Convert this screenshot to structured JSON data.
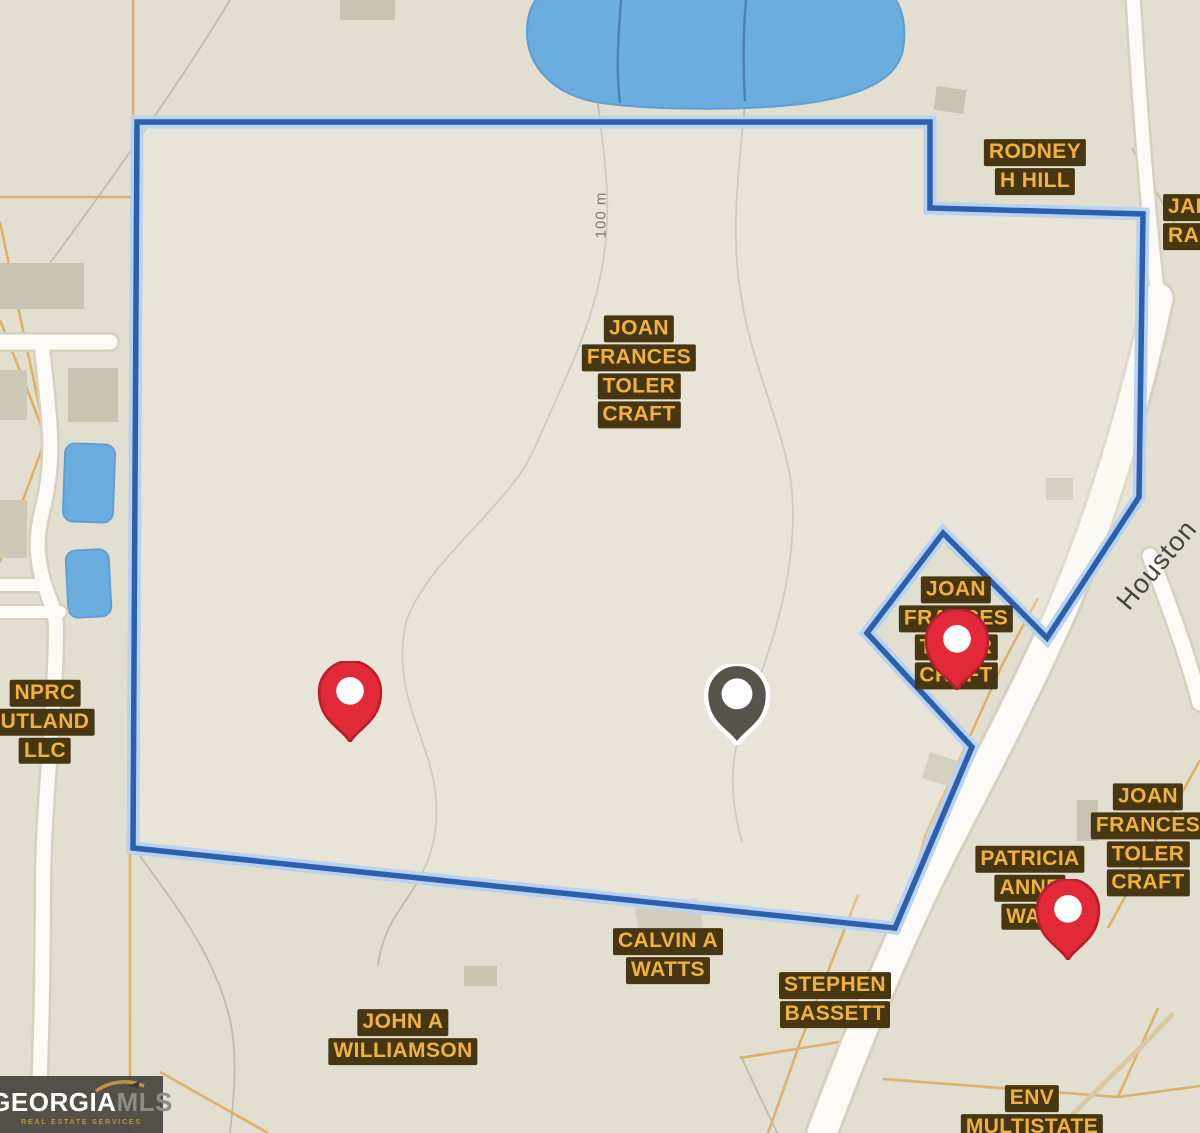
{
  "map": {
    "scale_label": "100 m",
    "road_label": "Houston",
    "parcels": {
      "rodney": {
        "lines": [
          "RODNEY",
          "H HILL"
        ]
      },
      "jai": {
        "lines": [
          "JAI",
          "RAN"
        ]
      },
      "joan_center": {
        "lines": [
          "JOAN",
          "FRANCES",
          "TOLER",
          "CRAFT"
        ]
      },
      "nprc": {
        "lines": [
          "NPRC",
          "UTLAND",
          "LLC"
        ]
      },
      "joan_diamond": {
        "lines": [
          "JOAN",
          "FRANCES",
          "TOLER",
          "CRAFT"
        ]
      },
      "patricia": {
        "lines": [
          "PATRICIA",
          "ANNE",
          "WAL"
        ]
      },
      "joan_right": {
        "lines": [
          "JOAN",
          "FRANCES",
          "TOLER",
          "CRAFT"
        ]
      },
      "calvin": {
        "lines": [
          "CALVIN A",
          "WATTS"
        ]
      },
      "stephen": {
        "lines": [
          "STEPHEN",
          "BASSETT"
        ]
      },
      "john": {
        "lines": [
          "JOHN A",
          "WILLIAMSON"
        ]
      },
      "env": {
        "lines": [
          "ENV",
          "MULTISTATE"
        ]
      }
    },
    "pins": [
      {
        "id": "pin-red-west",
        "color": "#e22937"
      },
      {
        "id": "pin-gray-center",
        "color": "#57544c"
      },
      {
        "id": "pin-red-east",
        "color": "#e22937"
      },
      {
        "id": "pin-red-southeast",
        "color": "#e22937"
      }
    ],
    "colors": {
      "boundary": "#2c5fae",
      "boundary_halo": "#b9d3ef",
      "water": "#6badde",
      "label_bg": "#463712",
      "label_text": "#f1b13e",
      "parcel_line": "#dfae62",
      "road_fill": "#fbfaf6"
    }
  },
  "logo": {
    "brand_primary": "GEORGIA",
    "brand_secondary": "MLS",
    "tagline": "REAL ESTATE SERVICES"
  }
}
